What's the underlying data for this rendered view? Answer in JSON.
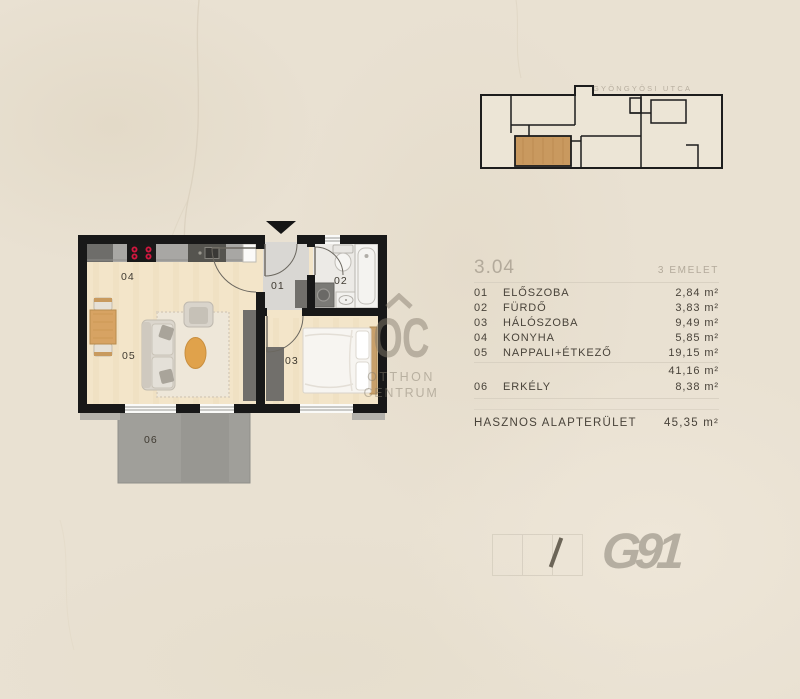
{
  "colors": {
    "background": "#e9e1d2",
    "wall": "#181818",
    "floor_wood": "#f3e5c9",
    "entrance_gray": "#d9d7d3",
    "balcony_gray": "#a09f9a",
    "highlight_wood": "#c9995f",
    "furniture_dark_gray": "#716f6b",
    "stove_burner_red": "#d2173f",
    "text_dark": "#49433a",
    "text_muted": "#b3aa9b",
    "logo_gray": "#b5aea1"
  },
  "site_plan": {
    "street_label": "GYÖNGYÖSI UTCA"
  },
  "room_list": {
    "unit_number": "3.04",
    "floor_label": "3 EMELET",
    "rows": [
      {
        "number": "01",
        "name": "ELŐSZOBA",
        "area": "2,84 m²"
      },
      {
        "number": "02",
        "name": "FÜRDŐ",
        "area": "3,83 m²"
      },
      {
        "number": "03",
        "name": "HÁLÓSZOBA",
        "area": "9,49 m²"
      },
      {
        "number": "04",
        "name": "KONYHA",
        "area": "5,85 m²"
      },
      {
        "number": "05",
        "name": "NAPPALI+ÉTKEZŐ",
        "area": "19,15 m²"
      }
    ],
    "subtotal_area": "41,16 m²",
    "extra": {
      "number": "06",
      "name": "ERKÉLY",
      "area": "8,38 m²"
    },
    "total_label": "HASZNOS ALAPTERÜLET",
    "total_area": "45,35 m²"
  },
  "watermark": {
    "monogram": "OC",
    "line1": "OTTHON",
    "line2": "CENTRUM"
  },
  "branding": {
    "logo_text": "G91"
  }
}
